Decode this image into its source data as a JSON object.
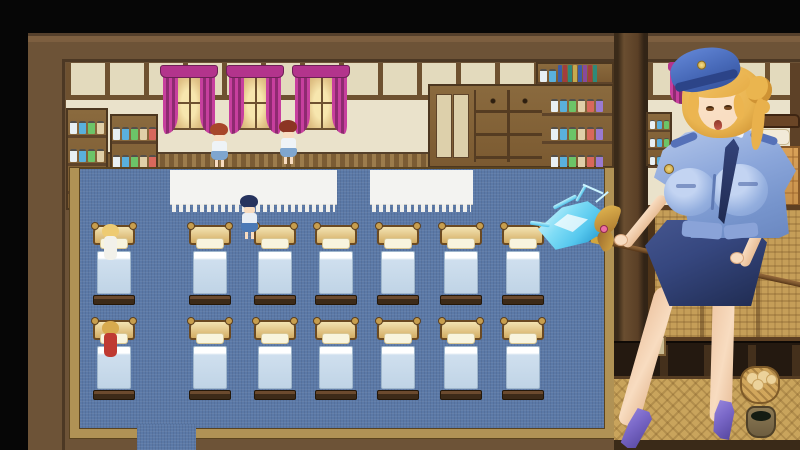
{
  "scene": {
    "viewport_name": "rpg-dormitory-room",
    "overlay_name": "police-uniform-woman-portrait"
  },
  "colors": {
    "frame": "#6d5337",
    "frameLight": "#7d5f40",
    "frameDark": "#4c3824",
    "wall": "#eae2cb",
    "wallPane": "#e3dabd",
    "woodLine": "#6e5130",
    "wood": "#8a6a3e",
    "woodMid": "#7b5a31",
    "woodDark": "#4c3720",
    "wainscot": "#7b5c34",
    "wainscotDash": "#9c7c4c",
    "curtain": "#c73f9e",
    "curtainDark": "#8e2a70",
    "valance": "#b3348c",
    "glow": "#f7e6ae",
    "glowDeep": "#c9a96a",
    "carpet": "#5b79a7",
    "carpetBorder": "#b09255",
    "carpetBorderDark": "#5a431f",
    "tableTop": "#f3f3f1",
    "bedHead": "#f3e3b2",
    "bedHeadDeep": "#d3ac63",
    "bedFrame": "#6b4a22",
    "bedKnob": "#c79e4e",
    "bedPillow": "#f8f4de",
    "bedSheetTop": "#ffffff",
    "bedSheet": "#cfdfee",
    "bedSheetDeep": "#c0d4e6",
    "bedFootTop": "#6b4a2e",
    "bedFoot": "#3c2a18",
    "skin": "#f8dcc0",
    "skinShade": "#e8bd96",
    "hairGold": "#e9b450",
    "hairDeep": "#cf9334",
    "cap": "#4769b8",
    "capDeep": "#2c4488",
    "shirt": "#8ba6da",
    "shirtLight": "#c3d4f2",
    "shirtDeep": "#6a87c0",
    "tie": "#2c3a6a",
    "skirt": "#36477f",
    "skirtDeep": "#1f2b50",
    "heel": "#7a68c8",
    "heelDeep": "#4e3f96",
    "staff": "#7c562e",
    "staffDark": "#553416",
    "staffBand": "#d2a63e",
    "crystalLight": "#d8f6fd",
    "crystal": "#56c8ee",
    "crystalDeep": "#1286c0",
    "horn": "#d8ab46",
    "gem": "#ec6fa4",
    "wicker": "#c59e58",
    "wickerLine": "#6e4b1e",
    "panelDark": "#241910",
    "panelPost": "#44301c",
    "postWood": "#5d4127",
    "floorWicker": "#c9a45c",
    "rBlanket": "#d9a158",
    "rBlanketLine": "#8a5a28",
    "rPillow": "#f2ead8",
    "rRail": "#6a4526",
    "basket": "#d2a75c",
    "basketDark": "#7e5a28",
    "potBody": "#8c7a54",
    "potInner": "#141c12"
  },
  "palette": {
    "jars": [
      "#e8f0f4",
      "#5ab0dc",
      "#6cc468",
      "#e0cfa8",
      "#d8685c",
      "#9a7ad0"
    ],
    "books": [
      "#3b5ca8",
      "#a33d3d",
      "#2f8a7a",
      "#c7a94e",
      "#3b5ca8",
      "#884a9c",
      "#a33d3d",
      "#2f8a7a"
    ],
    "bread": [
      {
        "x": 4,
        "y": 4,
        "s": 13
      },
      {
        "x": 15,
        "y": 2,
        "s": 14
      },
      {
        "x": 24,
        "y": 6,
        "s": 11
      },
      {
        "x": 10,
        "y": 11,
        "s": 12
      }
    ]
  },
  "map": {
    "windows_x": [
      163,
      229,
      295
    ],
    "tables": [
      {
        "x": 170,
        "y": 170,
        "w": 167,
        "h": 34
      },
      {
        "x": 370,
        "y": 170,
        "w": 103,
        "h": 34
      }
    ],
    "beds": {
      "cols_x": [
        95,
        191,
        256,
        317,
        379,
        442,
        504
      ],
      "rows_y": [
        225,
        320
      ],
      "w": 38,
      "h": 80
    },
    "npcs": [
      {
        "name": "npc-nurse-redhead",
        "x": 209,
        "y": 123,
        "hair": "#a8462a",
        "top": "#eef3f7",
        "skirt": "#7fa6cf"
      },
      {
        "name": "npc-nurse-pigtails",
        "x": 278,
        "y": 120,
        "hair": "#8c3524",
        "top": "#eef3f7",
        "skirt": "#7fa6cf"
      },
      {
        "name": "npc-player-bluehair",
        "x": 239,
        "y": 195,
        "hair": "#26335e",
        "top": "#e9eef4",
        "skirt": "#4b79b6"
      }
    ],
    "bed_occupants": [
      {
        "name": "npc-patient-blonde",
        "x": 100,
        "y": 224,
        "hair": "#eecb72",
        "body": "#f2f1ea"
      },
      {
        "name": "npc-patient-red",
        "x": 100,
        "y": 321,
        "hair": "#d8aa4e",
        "body": "#bf3a32"
      }
    ]
  }
}
